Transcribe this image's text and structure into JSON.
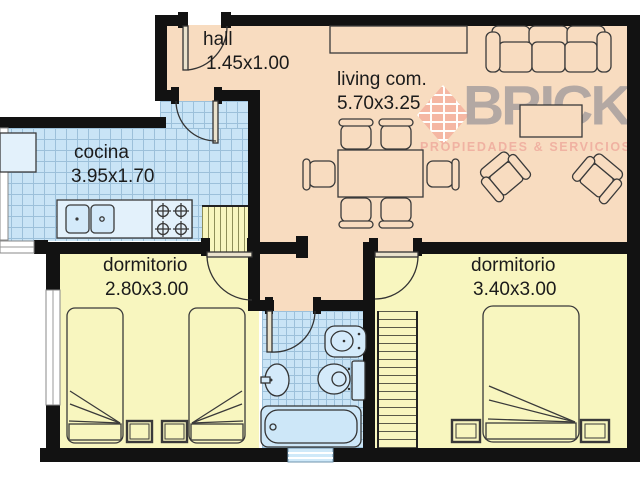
{
  "watermark": {
    "brand": "BRICK",
    "tagline": "PROPIEDADES & SERVICIOS"
  },
  "rooms": {
    "hall": {
      "label": "hall",
      "dims": "1.45x1.00"
    },
    "cocina": {
      "label": "cocina",
      "dims": "3.95x1.70"
    },
    "living": {
      "label": "living com.",
      "dims": "5.70x3.25"
    },
    "dormitorio1": {
      "label": "dormitorio",
      "dims": "2.80x3.00"
    },
    "dormitorio2": {
      "label": "dormitorio",
      "dims": "3.40x3.00"
    }
  },
  "colors": {
    "wall": "#121212",
    "social_floor": "#f8dcc0",
    "bedroom_floor": "#f8f6bf",
    "wet_floor": "#c9e4f6",
    "brand_salmon": "#f2b3a0",
    "brand_gray": "#a89f9f"
  }
}
